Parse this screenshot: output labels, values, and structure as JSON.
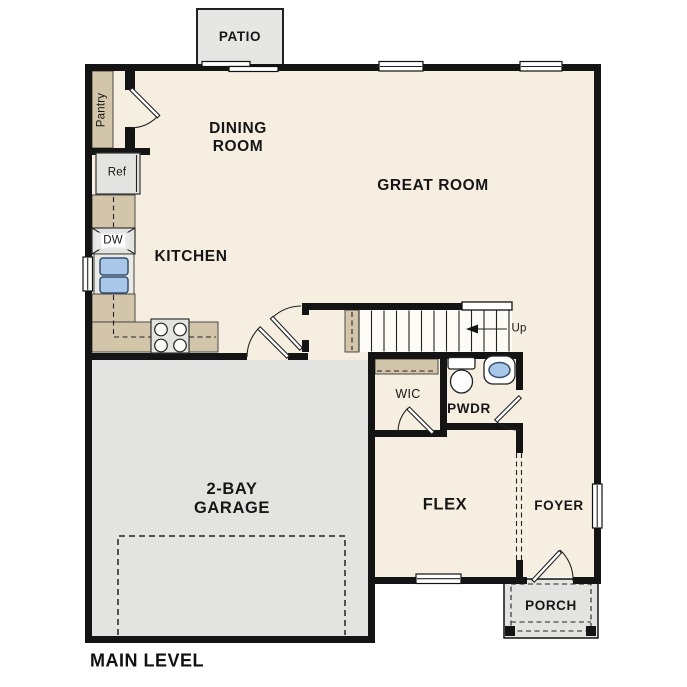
{
  "title": "MAIN LEVEL",
  "rooms": {
    "patio": "PATIO",
    "dining_room": "DINING ROOM",
    "great_room": "GREAT ROOM",
    "kitchen": "KITCHEN",
    "pantry": "Pantry",
    "garage": "2-BAY GARAGE",
    "wic": "WIC",
    "powder_room": "PWDR",
    "flex": "FLEX",
    "foyer": "FOYER",
    "porch": "PORCH"
  },
  "fixtures": {
    "refrigerator": "Ref",
    "dishwasher": "DW",
    "stairs_direction": "Up"
  },
  "colors": {
    "floor": "#f5eee1",
    "counter_tan": "#d3c5a9",
    "garage_gray": "#e3e3e1",
    "sink_blue": "#a9c8e9",
    "wall": "#141414",
    "text": "#161616"
  }
}
